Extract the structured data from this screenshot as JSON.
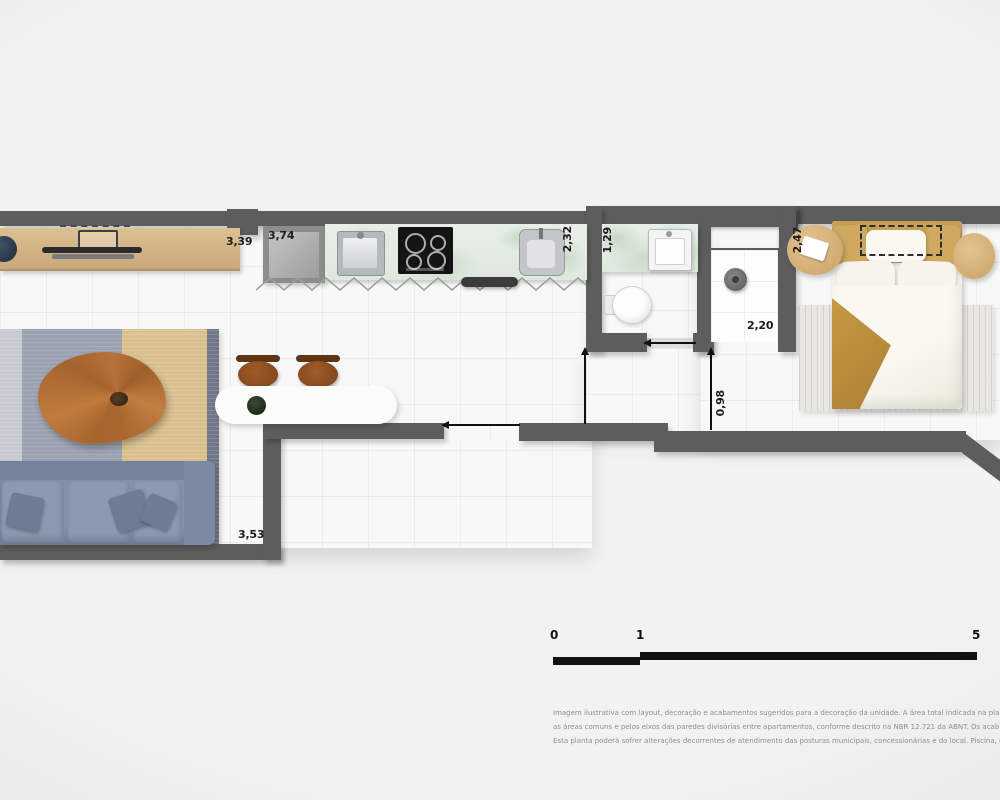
{
  "plan": {
    "dimensions": {
      "living_top": "3,39",
      "kitchen_top": "3,74",
      "kitchen_side": "2,32",
      "bathroom_side": "1,29",
      "bedroom_side": "2,47",
      "shower_width": "2,20",
      "bedroom_door": "0,98",
      "living_bottom": "3,53"
    },
    "scale_bar": {
      "tick_0": "0",
      "tick_1": "1",
      "tick_5": "5"
    },
    "disclaimer": {
      "line_1": "Imagem ilustrativa com layout, decoração e acabamentos sugeridos para a decoração da unidade. A área total indicada na pla",
      "line_2": "as áreas comuns e pelos eixos das paredes divisórias entre apartamentos, conforme descrito na NBR 12.721 da ABNT. Os acab",
      "line_3": "Esta planta poderá sofrer alterações decorrentes de atendimento das posturas municipais, concessionárias e do local. Piscina, e"
    },
    "colors": {
      "wall": "#5d5d5d",
      "floor": "#f8f8f8",
      "wood_light": "#d5b78c",
      "sofa_blue": "#8290a8",
      "rug_tan": "#dac08e",
      "counter_marble": "#e6ece5",
      "stool_brown": "#8c4f22",
      "blanket_tan": "#bb8f3e",
      "scale_black": "#111111",
      "dimension_text": "#1c1c1c",
      "disclaimer_gray": "#8e8e8e"
    }
  }
}
